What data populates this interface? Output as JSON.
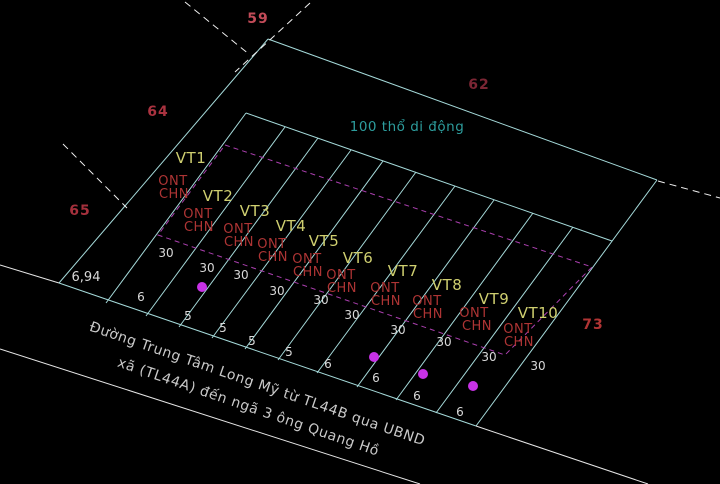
{
  "canvas": {
    "width": 720,
    "height": 484,
    "background": "#000000"
  },
  "colors": {
    "boundary_cyan": "#a5dada",
    "white_line": "#e6e6e6",
    "dashed_white": "#f0f0f0",
    "dashed_magenta": "#aa3fae",
    "survey_dot": "#c832e6",
    "parcel_label": "#cfcf70",
    "land_use": "#ad3434",
    "dim_text": "#d9d9d9",
    "note_text": "#2d9d9d",
    "road_text": "#c9c9c9"
  },
  "annotations": {
    "area_note": {
      "text": "100 thổ di động",
      "xy": [
        407,
        126
      ]
    },
    "edge_dim": {
      "text": "6,94",
      "xy": [
        86,
        277
      ]
    },
    "road": {
      "line1": "Đường Trung Tâm Long Mỹ từ TL44B qua UBND",
      "line2": "xã (TL44A) đến ngã 3 ông Quang Hồ",
      "angle_deg": 19,
      "line1_xy": [
        256,
        388
      ],
      "line2_xy": [
        247,
        411
      ]
    }
  },
  "adjacent_plot_numbers": [
    {
      "number": "59",
      "xy": [
        258,
        18
      ],
      "color": "#c24b58"
    },
    {
      "number": "62",
      "xy": [
        479,
        84
      ],
      "color": "#7c2634"
    },
    {
      "number": "64",
      "xy": [
        158,
        111
      ],
      "color": "#aa3340"
    },
    {
      "number": "65",
      "xy": [
        80,
        210
      ],
      "color": "#a5303c"
    },
    {
      "number": "73",
      "xy": [
        593,
        324
      ],
      "color": "#b03434"
    }
  ],
  "parcels": [
    {
      "id": "VT1",
      "label_xy": [
        191,
        158
      ],
      "land_use": [
        "ONT",
        "CHN"
      ],
      "lu_xy": [
        [
          173,
          180
        ],
        [
          174,
          193
        ]
      ],
      "depth": "30",
      "depth_xy": [
        166,
        253
      ],
      "frontage": "6",
      "front_xy": [
        141,
        297
      ]
    },
    {
      "id": "VT2",
      "label_xy": [
        218,
        196
      ],
      "land_use": [
        "ONT",
        "CHN"
      ],
      "lu_xy": [
        [
          198,
          213
        ],
        [
          199,
          226
        ]
      ],
      "depth": "30",
      "depth_xy": [
        207,
        268
      ],
      "frontage": "5",
      "front_xy": [
        188,
        316
      ]
    },
    {
      "id": "VT3",
      "label_xy": [
        255,
        211
      ],
      "land_use": [
        "ONT",
        "CHN"
      ],
      "lu_xy": [
        [
          238,
          228
        ],
        [
          239,
          241
        ]
      ],
      "depth": "30",
      "depth_xy": [
        241,
        275
      ],
      "frontage": "5",
      "front_xy": [
        223,
        328
      ]
    },
    {
      "id": "VT4",
      "label_xy": [
        291,
        226
      ],
      "land_use": [
        "ONT",
        "CHN"
      ],
      "lu_xy": [
        [
          272,
          243
        ],
        [
          273,
          256
        ]
      ],
      "depth": "30",
      "depth_xy": [
        277,
        291
      ],
      "frontage": "5",
      "front_xy": [
        252,
        341
      ]
    },
    {
      "id": "VT5",
      "label_xy": [
        324,
        241
      ],
      "land_use": [
        "ONT",
        "CHN"
      ],
      "lu_xy": [
        [
          307,
          258
        ],
        [
          308,
          271
        ]
      ],
      "depth": "30",
      "depth_xy": [
        321,
        300
      ],
      "frontage": "5",
      "front_xy": [
        289,
        352
      ]
    },
    {
      "id": "VT6",
      "label_xy": [
        358,
        258
      ],
      "land_use": [
        "ONT",
        "CHN"
      ],
      "lu_xy": [
        [
          341,
          274
        ],
        [
          342,
          287
        ]
      ],
      "depth": "30",
      "depth_xy": [
        352,
        315
      ],
      "frontage": "6",
      "front_xy": [
        328,
        364
      ]
    },
    {
      "id": "VT7",
      "label_xy": [
        403,
        271
      ],
      "land_use": [
        "ONT",
        "CHN"
      ],
      "lu_xy": [
        [
          385,
          287
        ],
        [
          386,
          300
        ]
      ],
      "depth": "30",
      "depth_xy": [
        398,
        330
      ],
      "frontage": "6",
      "front_xy": [
        376,
        378
      ]
    },
    {
      "id": "VT8",
      "label_xy": [
        447,
        285
      ],
      "land_use": [
        "ONT",
        "CHN"
      ],
      "lu_xy": [
        [
          427,
          300
        ],
        [
          428,
          313
        ]
      ],
      "depth": "30",
      "depth_xy": [
        444,
        342
      ],
      "frontage": "6",
      "front_xy": [
        417,
        396
      ]
    },
    {
      "id": "VT9",
      "label_xy": [
        494,
        299
      ],
      "land_use": [
        "ONT",
        "CHN"
      ],
      "lu_xy": [
        [
          474,
          312
        ],
        [
          477,
          325
        ]
      ],
      "depth": "30",
      "depth_xy": [
        489,
        357
      ],
      "frontage": "6",
      "front_xy": [
        460,
        412
      ]
    },
    {
      "id": "VT10",
      "label_xy": [
        538,
        313
      ],
      "land_use": [
        "ONT",
        "CHN"
      ],
      "lu_xy": [
        [
          518,
          328
        ],
        [
          519,
          341
        ]
      ],
      "depth": "30",
      "depth_xy": [
        538,
        366
      ],
      "frontage": null,
      "front_xy": null
    }
  ],
  "geometry": {
    "cyan_lines": [
      [
        [
          268,
          39
        ],
        [
          657,
          180
        ]
      ],
      [
        [
          268,
          39
        ],
        [
          59,
          283
        ]
      ],
      [
        [
          59,
          283
        ],
        [
          476,
          426
        ]
      ],
      [
        [
          657,
          180
        ],
        [
          476,
          426
        ]
      ],
      [
        [
          246,
          113
        ],
        [
          612,
          241
        ]
      ],
      [
        [
          246,
          113
        ],
        [
          106,
          303
        ]
      ],
      [
        [
          285,
          127
        ],
        [
          146,
          316
        ]
      ],
      [
        [
          318,
          138
        ],
        [
          179,
          327
        ]
      ],
      [
        [
          351,
          150
        ],
        [
          212,
          338
        ]
      ],
      [
        [
          383,
          161
        ],
        [
          245,
          349
        ]
      ],
      [
        [
          416,
          172
        ],
        [
          278,
          360
        ]
      ],
      [
        [
          455,
          186
        ],
        [
          317,
          373
        ]
      ],
      [
        [
          494,
          200
        ],
        [
          357,
          387
        ]
      ],
      [
        [
          533,
          213
        ],
        [
          396,
          400
        ]
      ],
      [
        [
          573,
          227
        ],
        [
          436,
          413
        ]
      ]
    ],
    "white_lines": [
      [
        [
          0,
          265
        ],
        [
          59,
          283
        ]
      ],
      [
        [
          0,
          349
        ],
        [
          420,
          484
        ]
      ],
      [
        [
          476,
          426
        ],
        [
          648,
          484
        ]
      ]
    ],
    "dashed_white_lines": [
      [
        [
          185,
          2
        ],
        [
          250,
          55
        ]
      ],
      [
        [
          310,
          3
        ],
        [
          235,
          72
        ]
      ],
      [
        [
          63,
          144
        ],
        [
          127,
          208
        ]
      ],
      [
        [
          658,
          181
        ],
        [
          720,
          198
        ]
      ]
    ],
    "dashed_magenta_polygon": [
      [
        225,
        145
      ],
      [
        592,
        267
      ],
      [
        505,
        355
      ],
      [
        158,
        235
      ]
    ],
    "survey_dots": [
      [
        202,
        287
      ],
      [
        374,
        357
      ],
      [
        423,
        374
      ],
      [
        473,
        386
      ]
    ],
    "dot_radius": 5
  }
}
